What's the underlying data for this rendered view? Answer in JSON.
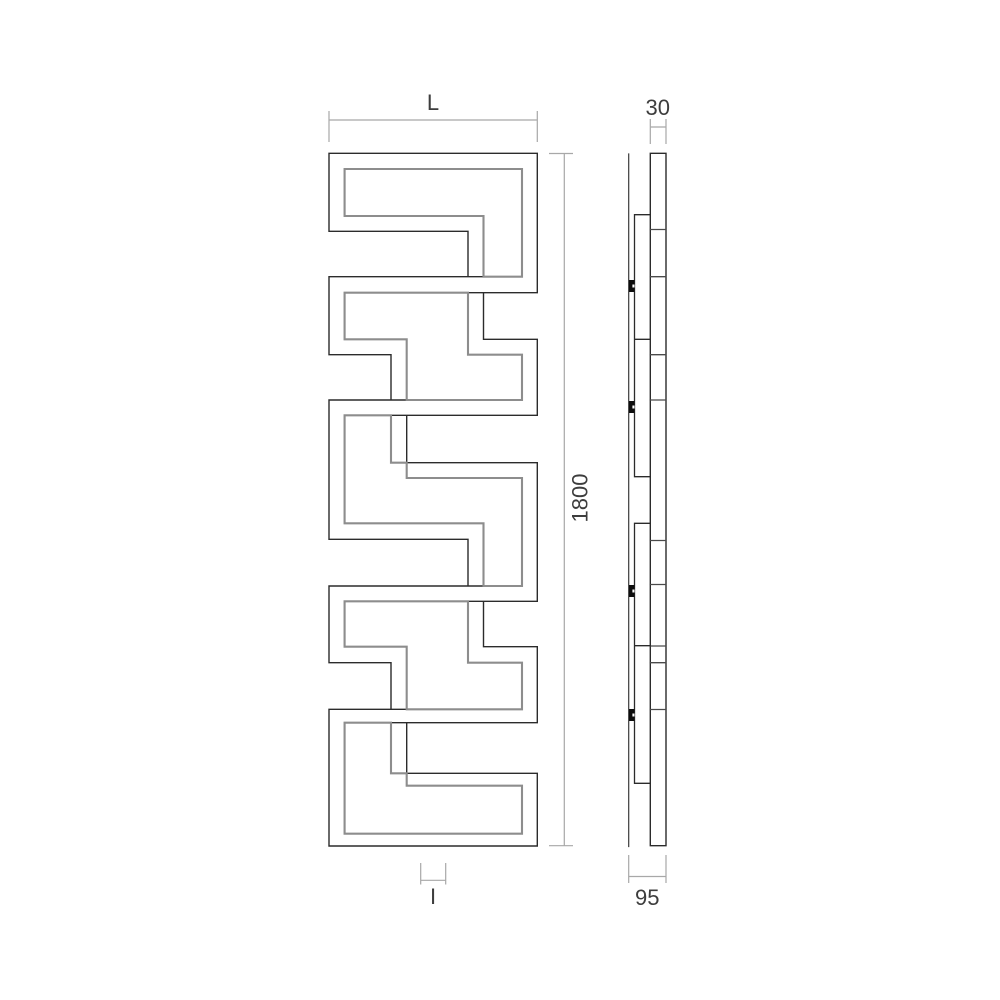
{
  "drawing": {
    "type": "radiator technical elevation, front and side views",
    "views": {
      "front": "meander serpentine tube panel",
      "side": "wall-mounted profile with brackets"
    }
  },
  "dimensions": {
    "width_label": "L",
    "depth_mm": "30",
    "height_mm": "1800",
    "connection_label": "I",
    "wall_distance_mm": "95"
  },
  "colors": {
    "outline": "#2b2b2b",
    "inner_contour": "#8d8d8d",
    "side_divider": "#4a4a4a",
    "wall_line": "#3a3a3a",
    "dimension_line": "#a8a8a8",
    "label": "#3d3d3d",
    "clip_fill": "#0d0d0d",
    "background": "#ffffff"
  }
}
